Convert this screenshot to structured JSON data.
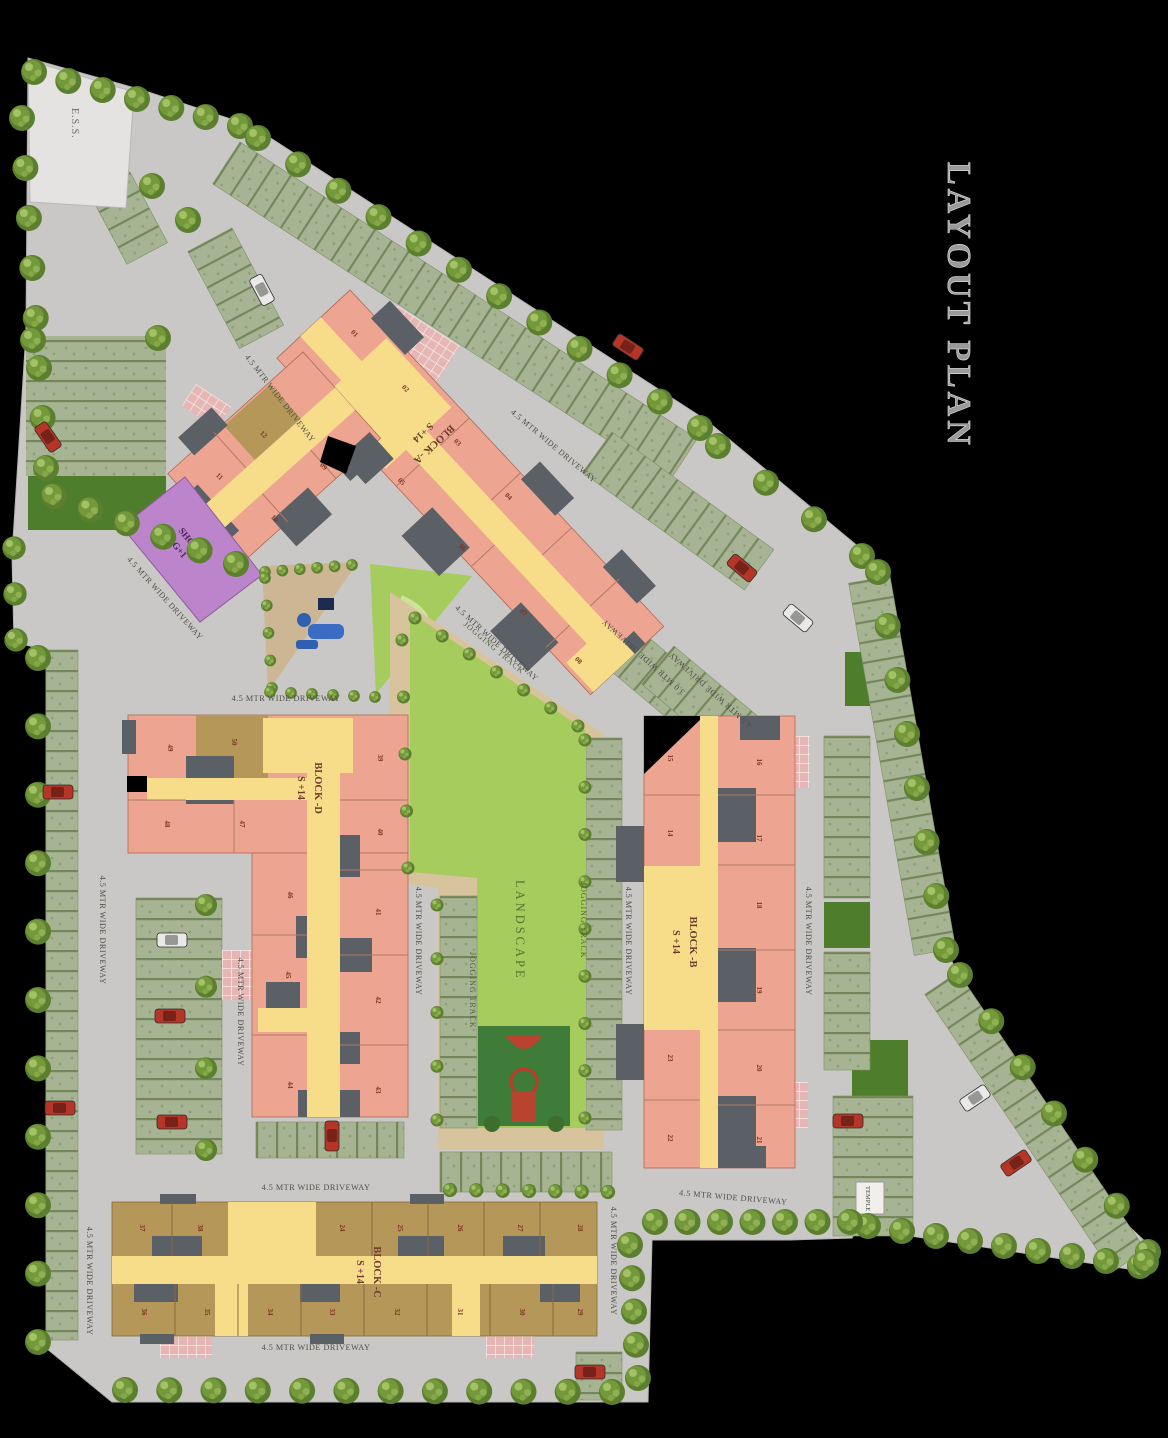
{
  "title": "LAYOUT PLAN",
  "labels": {
    "driveway_45": "4.5 MTR WIDE DRIVEWAY",
    "driveway_30": "3.0 MTR WIDE DRIVEWAY",
    "jogging_track": "JOGGING TRACK",
    "landscape": "LANDSCAPE",
    "ess": "E.S.S.",
    "shops_line1": "SHOPS",
    "shops_line2": "G+1",
    "temple": "TEMPLE"
  },
  "blocks": [
    {
      "id": "A",
      "name": "BLOCK -A",
      "floors": "S +14",
      "units": [
        "01",
        "02",
        "03",
        "04",
        "05",
        "06",
        "07",
        "08",
        "09",
        "10",
        "11",
        "12"
      ]
    },
    {
      "id": "B",
      "name": "BLOCK -B",
      "floors": "S +14",
      "units": [
        "15",
        "14",
        "16",
        "17",
        "18",
        "19",
        "20",
        "21",
        "23",
        "22"
      ]
    },
    {
      "id": "C",
      "name": "BLOCK -C",
      "floors": "S +14",
      "units": [
        "37",
        "38",
        "24",
        "25",
        "26",
        "27",
        "28",
        "36",
        "35",
        "34",
        "33",
        "32",
        "31",
        "30",
        "29"
      ]
    },
    {
      "id": "D",
      "name": "BLOCK -D",
      "floors": "S +14",
      "units": [
        "49",
        "50",
        "48",
        "47",
        "39",
        "40",
        "41",
        "42",
        "43",
        "46",
        "45",
        "44"
      ]
    }
  ],
  "colors": {
    "background": "#000000",
    "road_gray": "#c9c8c6",
    "building_pink": "#eda592",
    "corridor_yellow": "#f7dd8a",
    "block_c_brown": "#b5975a",
    "shops_purple": "#bc84cb",
    "core_gray": "#5b5f66",
    "landscape_green": "#a6cc5e",
    "lawn_dark_green": "#4e7d2b",
    "jogging_track_tan": "#d8c49c",
    "parking_hatch_green": "#a7b494",
    "crosswalk_pink": "#e5b6b4",
    "ess_light": "#e4e3e1",
    "tree_green": "#74993b",
    "car_red": "#b53527",
    "car_white": "#e9e9e7"
  }
}
